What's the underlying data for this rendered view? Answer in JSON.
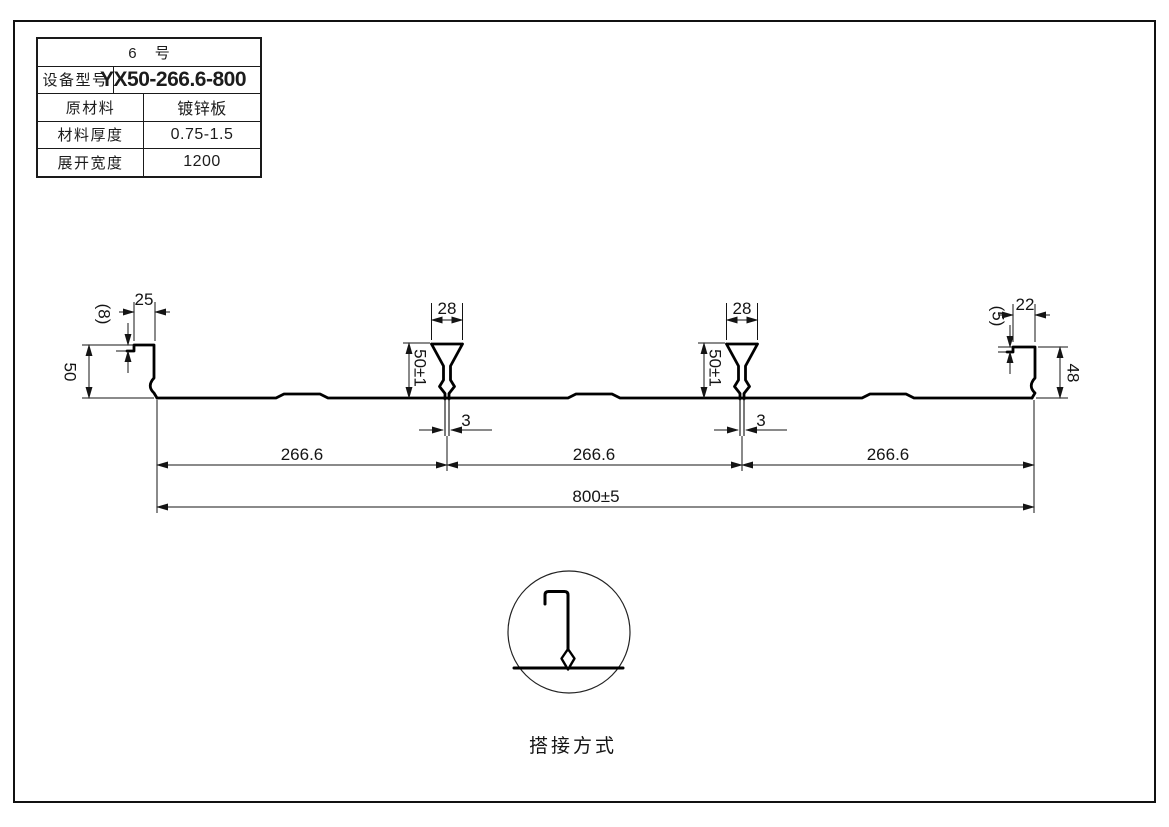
{
  "spec_table": {
    "header": "6 号",
    "rows": [
      {
        "label": "设备型号",
        "value": "YX50-266.6-800"
      },
      {
        "label": "原材料",
        "value": "镀锌板"
      },
      {
        "label": "材料厚度",
        "value": "0.75-1.5"
      },
      {
        "label": "展开宽度",
        "value": "1200"
      }
    ]
  },
  "profile": {
    "dims": {
      "left_lip": "(8)",
      "left_top": "25",
      "left_height": "50",
      "rib_top_1": "28",
      "rib_top_2": "28",
      "rib_height_1": "50±1",
      "rib_height_2": "50±1",
      "rib_slot_1": "3",
      "rib_slot_2": "3",
      "right_lip": "(5)",
      "right_top": "22",
      "right_height": "48",
      "pitch_1": "266.6",
      "pitch_2": "266.6",
      "pitch_3": "266.6",
      "overall_width": "800±5"
    }
  },
  "lap_detail": {
    "caption": "搭接方式"
  }
}
